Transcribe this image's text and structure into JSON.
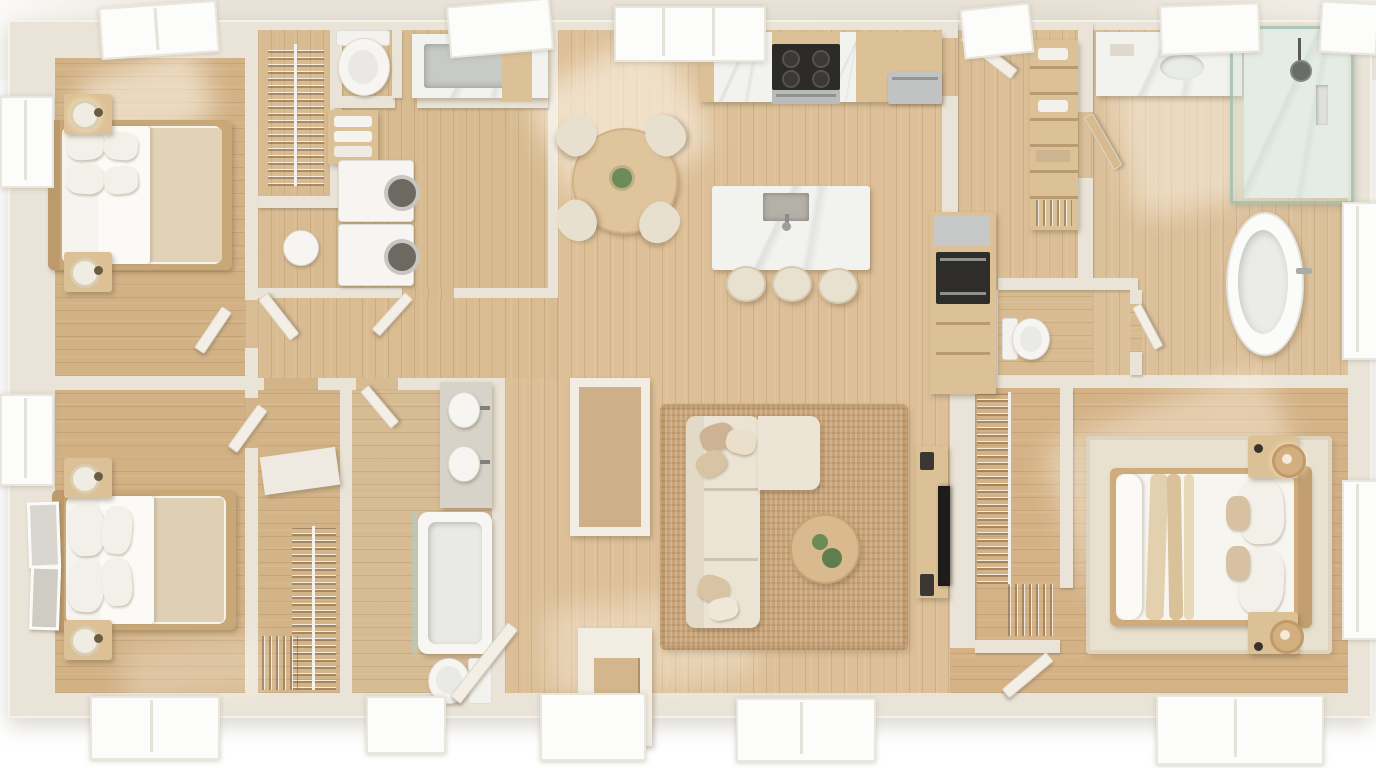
{
  "scene": {
    "type": "3d-floor-plan-top-view",
    "style": "scandinavian-minimal-apartment",
    "floors": "light oak plank",
    "walls": "warm cream"
  },
  "palette": {
    "bg": "#ffffff",
    "ground": "#e8e2d8",
    "wall": "#eae4d8",
    "wall-light": "#f4f0e8",
    "wood-bedroom": "#d2b185",
    "wood-open": "#ddc098",
    "wood-service": "#d8bb90",
    "cabinet": "#dcc096",
    "marble": "#f2f2ef",
    "steel": "#c3c6c4",
    "appliance-dark": "#2c2b28",
    "sofa-cream": "#ebe3d3",
    "tan": "#d9c3a2",
    "jute": "#c9a478",
    "linen-white": "#f6f4ee",
    "glass": "#cfe2d6",
    "plant-green": "#6d8b58",
    "rattan": "#d3ae7e"
  },
  "rooms": [
    {
      "id": "bedroom-1",
      "name": "Bedroom (top-left)",
      "furniture": [
        "double bed with white duvet and beige blanket",
        "4 pillows",
        "2 wood nightstands",
        "2 lamps",
        "skylight"
      ]
    },
    {
      "id": "closet-1",
      "name": "Reach-in closet",
      "furniture": [
        "hanging clothes rod",
        "laundry hamper"
      ]
    },
    {
      "id": "laundry-bath",
      "name": "Laundry / bathroom",
      "furniture": [
        "toilet",
        "stainless sink with marble counter",
        "stacked washer and dryer",
        "towel shelf"
      ]
    },
    {
      "id": "dining",
      "name": "Dining area",
      "furniture": [
        "round wood table",
        "4 cream chairs",
        "potted plant",
        "skylight window"
      ]
    },
    {
      "id": "kitchen",
      "name": "Kitchen",
      "furniture": [
        "wood cabinets",
        "cooktop with oven",
        "dishwasher",
        "marble island with sink",
        "3 stools",
        "tall unit with wall oven and fridge"
      ]
    },
    {
      "id": "pantry",
      "name": "Pantry shelving",
      "furniture": [
        "wood shelves with dishes and linens"
      ]
    },
    {
      "id": "master-bath",
      "name": "Master bathroom (top-right)",
      "furniture": [
        "marble vanity with faucet",
        "glass walk-in shower",
        "freestanding oval bathtub",
        "window",
        "skylight"
      ]
    },
    {
      "id": "wc",
      "name": "Water closet",
      "furniture": [
        "toilet"
      ]
    },
    {
      "id": "bathroom-2",
      "name": "Center bathroom",
      "furniture": [
        "double-sink vanity",
        "bathtub with glass screen",
        "toilet"
      ]
    },
    {
      "id": "walk-in-closet-2",
      "name": "Walk-in closet (center-left)",
      "furniture": [
        "hanging clothes",
        "sloped shelf",
        "shoe rack"
      ]
    },
    {
      "id": "bedroom-2",
      "name": "Bedroom (bottom-left)",
      "furniture": [
        "double bed",
        "2 nightstands with lamps",
        "2 framed artworks",
        "window"
      ]
    },
    {
      "id": "living",
      "name": "Living room",
      "furniture": [
        "L-shaped cream sectional sofa",
        "throw pillows",
        "round wood coffee table with plants",
        "jute rug",
        "TV on wall",
        "media console"
      ]
    },
    {
      "id": "entry",
      "name": "Entry",
      "furniture": [
        "front door",
        "entry closet",
        "console nook"
      ]
    },
    {
      "id": "walk-in-closet-3",
      "name": "Walk-in closet (master)",
      "furniture": [
        "hanging clothes rods",
        "folded clothes shelves"
      ]
    },
    {
      "id": "bedroom-3",
      "name": "Master bedroom (bottom-right)",
      "furniture": [
        "king bed with white duvet and beige throws",
        "2 nightstands",
        "2 rattan lamps",
        "area rug",
        "2 windows"
      ]
    }
  ],
  "openings": {
    "skylights": 6,
    "bottom_windows": 5,
    "left_windows": 2,
    "right_windows": 2,
    "front_door": 1,
    "interior_doors_open": 9
  }
}
